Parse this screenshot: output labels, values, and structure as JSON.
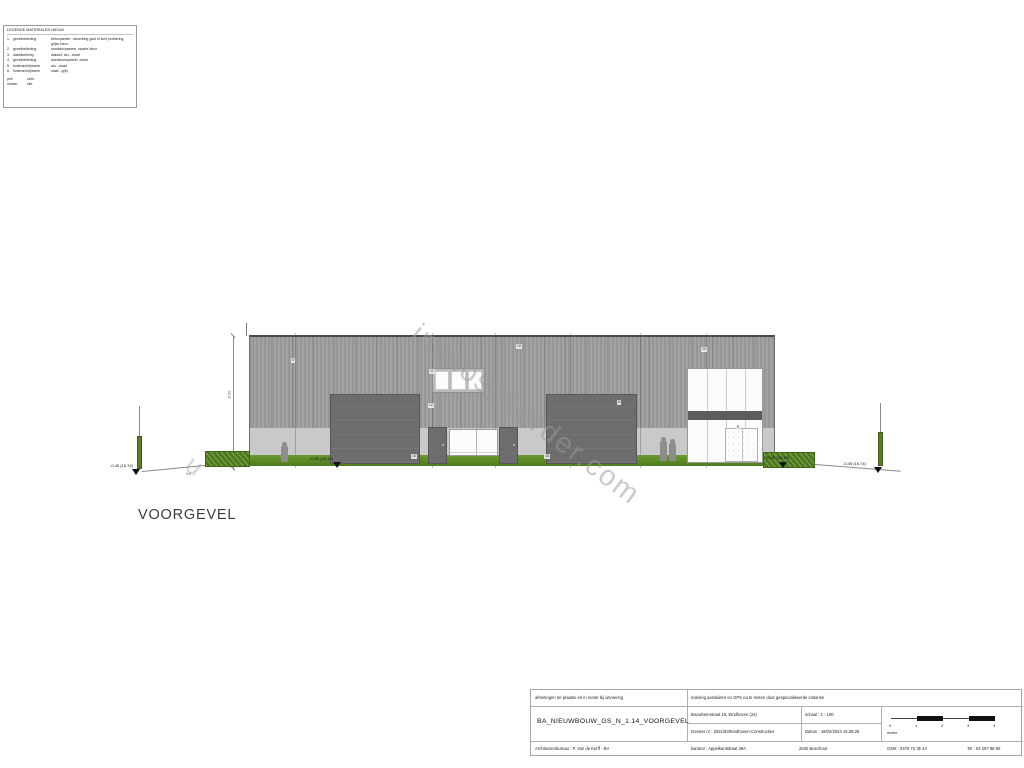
{
  "legend": {
    "title": "LEGENDE MATERIALEN NIEUW",
    "rows": [
      {
        "num": "1.",
        "term": "gevelbekleding",
        "desc": "betonpaneel - afwerking glad of licht profilering, grijze kleur"
      },
      {
        "num": "2.",
        "term": "gevelbekleding",
        "desc": "sandwichpaneel, zwarte kleur"
      },
      {
        "num": "3.",
        "term": "dakafwerking",
        "desc": "dakzeil, alu - zwart"
      },
      {
        "num": "4.",
        "term": "gevelbekleding",
        "desc": "aluminiumpaneel, zwart"
      },
      {
        "num": "5.",
        "term": "buitenschrijnwerk",
        "desc": "alu - zwart"
      },
      {
        "num": "6.",
        "term": "buitenschrijnwerk",
        "desc": "staal - grijs"
      }
    ],
    "footer": [
      {
        "k": "peil",
        "v": "zicht"
      },
      {
        "k": "niveau",
        "v": "site"
      }
    ]
  },
  "watermark": "immospeurder.com",
  "watermark_fragment": "u",
  "drawing": {
    "title": "VOORGEVEL",
    "dim_label": "8.50",
    "slope_label": "1%",
    "levels": {
      "left_post": "-0.45 (15.74)",
      "door": "+0.00 (16.19)",
      "hedge": "+0.00 (16.19)",
      "right_post": "-0.45 (15.74)"
    },
    "tags": [
      {
        "label": "6"
      },
      {
        "label": "12"
      },
      {
        "label": "10"
      },
      {
        "label": "14"
      },
      {
        "label": "12"
      },
      {
        "label": "8"
      },
      {
        "label": "5"
      },
      {
        "label": "15"
      },
      {
        "label": "16"
      }
    ],
    "colors": {
      "facade": "#9d9d9d",
      "plinth": "#c9c9c9",
      "door": "#6d6d6d",
      "band": "#5c5c5c",
      "grass": "#5e8f25",
      "hedge": "#4c7a1b",
      "marker": "#111111"
    }
  },
  "titleblock": {
    "note_left": "afmetingen ter plaatse en in meter bij uitvoering",
    "note_right": "riolering aansluiten en GPS na te meten door gespecialiseerde instantie",
    "drawing_name": "BA_NIEUWBOUW_GS_N_1.14_VOORGEVEL",
    "address": "Bouwheerstraat 16, Eindhoven (24)",
    "scale": "schaal : 1 - 100",
    "dossier": "Dossier nr : 2021/83/Eindhoven-Constructies",
    "date": "Datum : 19/02/2024 16:38:26",
    "scalebar": {
      "ticks": [
        "0",
        "1",
        "2",
        "3",
        "4"
      ],
      "unit": "meter"
    },
    "firm": "Architectenbureau : P. Van de Kerff - BV",
    "office": "kantoor : Appelkantstraat 39A",
    "city": "2530 Boechout",
    "gsm": "GSM : 0475 72 35 44",
    "tel": "Tel : 03 297 96 90"
  }
}
